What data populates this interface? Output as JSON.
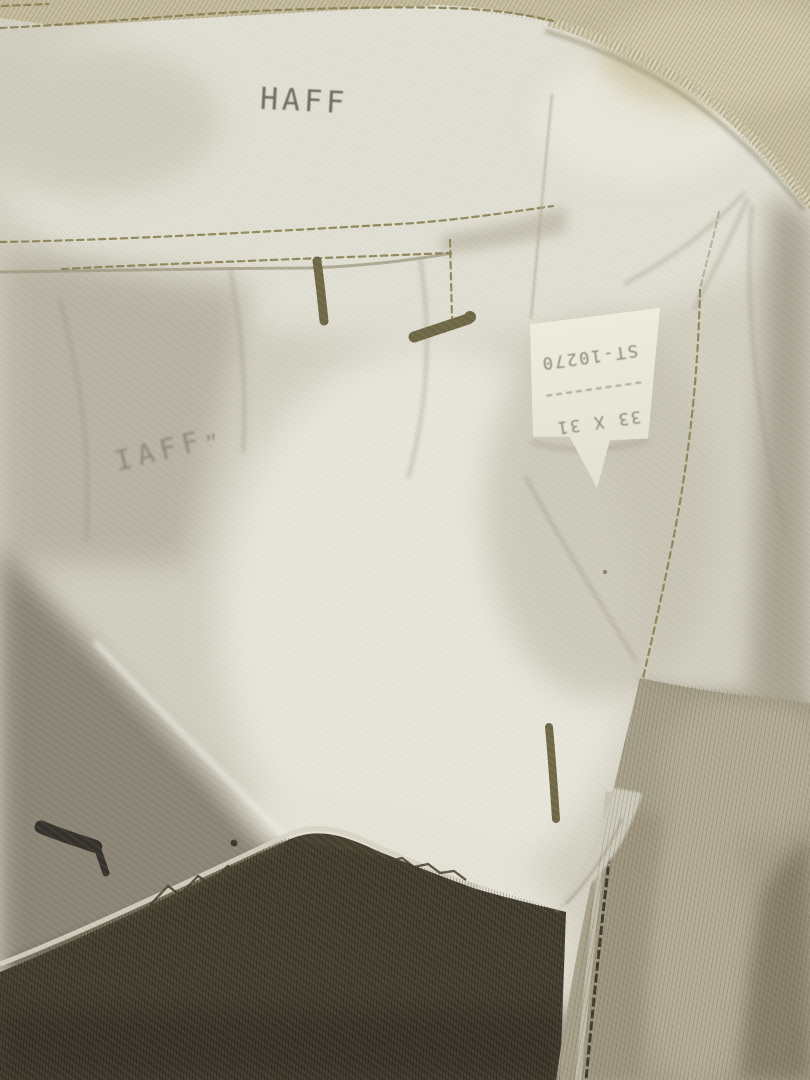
{
  "photo": {
    "subject": "Close-up of the inside waistband and pocket lining of vintage khaki trousers",
    "stamps": {
      "primary": "HAFF",
      "secondary_faded": "IAFF",
      "secondary_mark": "”"
    },
    "label": {
      "stock_number": "ST-10270",
      "size": "33 X 31",
      "printed_upside_down": true
    },
    "colors": {
      "shell_tan": "#c8bfa1",
      "lining_white": "#d6d3c5",
      "shell_dark_olive": "#463f30",
      "fly_khaki": "#a8a18b",
      "thread_olive": "#878050",
      "label_background": "#eae8da",
      "stamp_ink": "#585746"
    }
  }
}
